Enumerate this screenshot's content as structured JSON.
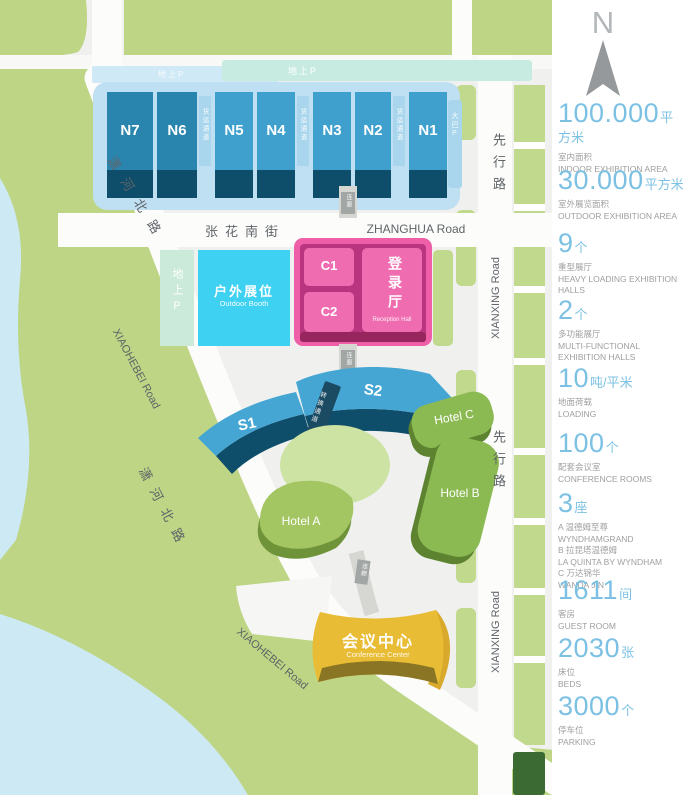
{
  "map": {
    "compass_n": "N",
    "parking_bar_top": "地上P",
    "parking_bar_left": "地上P",
    "parking_strip": "地上P",
    "bus_parking_strip": "大巴P",
    "halls_n": [
      "N7",
      "N6",
      "N5",
      "N4",
      "N3",
      "N2",
      "N1"
    ],
    "halls_s": [
      "S1",
      "S2"
    ],
    "freight_passage": "货运通道",
    "transfer_passage": "转换通道",
    "corridor": "连廊",
    "roads": {
      "zhanghua_cn": "张花南街",
      "zhanghua_en": "ZHANGHUA Road",
      "xianxing_cn": "先行路",
      "xianxing_en": "XIANXING Road",
      "xiaohebei_cn": "潇河北路",
      "xiaohebei_en": "XIAOHEBEI Road"
    },
    "center": {
      "c1": "C1",
      "c2": "C2",
      "reception_cn": "登录厅",
      "reception_en": "Reception Hall"
    },
    "outdoor_cn": "户外展位",
    "outdoor_en": "Outdoor Booth",
    "hotels": [
      "Hotel A",
      "Hotel B",
      "Hotel C"
    ],
    "conference_cn": "会议中心",
    "conference_en": "Conference Center"
  },
  "stats": [
    {
      "value": "100.000",
      "unit": "平方米",
      "sub": [
        "室内面积",
        "INDOOR EXHIBITION AREA"
      ]
    },
    {
      "value": "30.000",
      "unit": "平方米",
      "sub": [
        "室外展览面积",
        "OUTDOOR EXHIBITION AREA"
      ]
    },
    {
      "value": "9",
      "unit": "个",
      "sub": [
        "重型展厅",
        "HEAVY LOADING EXHIBITION HALLS"
      ]
    },
    {
      "value": "2",
      "unit": "个",
      "sub": [
        "多功能展厅",
        "MULTI-FUNCTIONAL EXHIBITION HALLS"
      ]
    },
    {
      "value": "10",
      "unit": "吨/平米",
      "sub": [
        "地面荷载",
        "LOADING"
      ]
    },
    {
      "value": "100",
      "unit": "个",
      "sub": [
        "配套会议室",
        "CONFERENCE ROOMS"
      ]
    },
    {
      "value": "3",
      "unit": "座",
      "sub": [
        "A 温德姆至尊",
        "WYNDHAMGRAND",
        "B 拉昆塔温德姆",
        "LA QUINTA BY WYNDHAM",
        "C 万达锦华",
        "WANDA JIN"
      ]
    },
    {
      "value": "1611",
      "unit": "间",
      "sub": [
        "客房",
        "GUEST ROOM"
      ]
    },
    {
      "value": "2030",
      "unit": "张",
      "sub": [
        "床位",
        "BEDS"
      ]
    },
    {
      "value": "3000",
      "unit": "个",
      "sub": [
        "停车位",
        "PARKING"
      ]
    }
  ],
  "colors": {
    "accent_blue": "#7cc1e3",
    "hall_blue": "#3f9fcd",
    "hall_blue_dark": "#2a85ae",
    "hall_base": "#0e4e6b",
    "pink": "#ee5fa8",
    "cyan": "#3ed1f2",
    "gold": "#e9bc35",
    "hotel_green": "#8cba52",
    "park_green": "#bdd584",
    "water": "#cde9f3"
  }
}
